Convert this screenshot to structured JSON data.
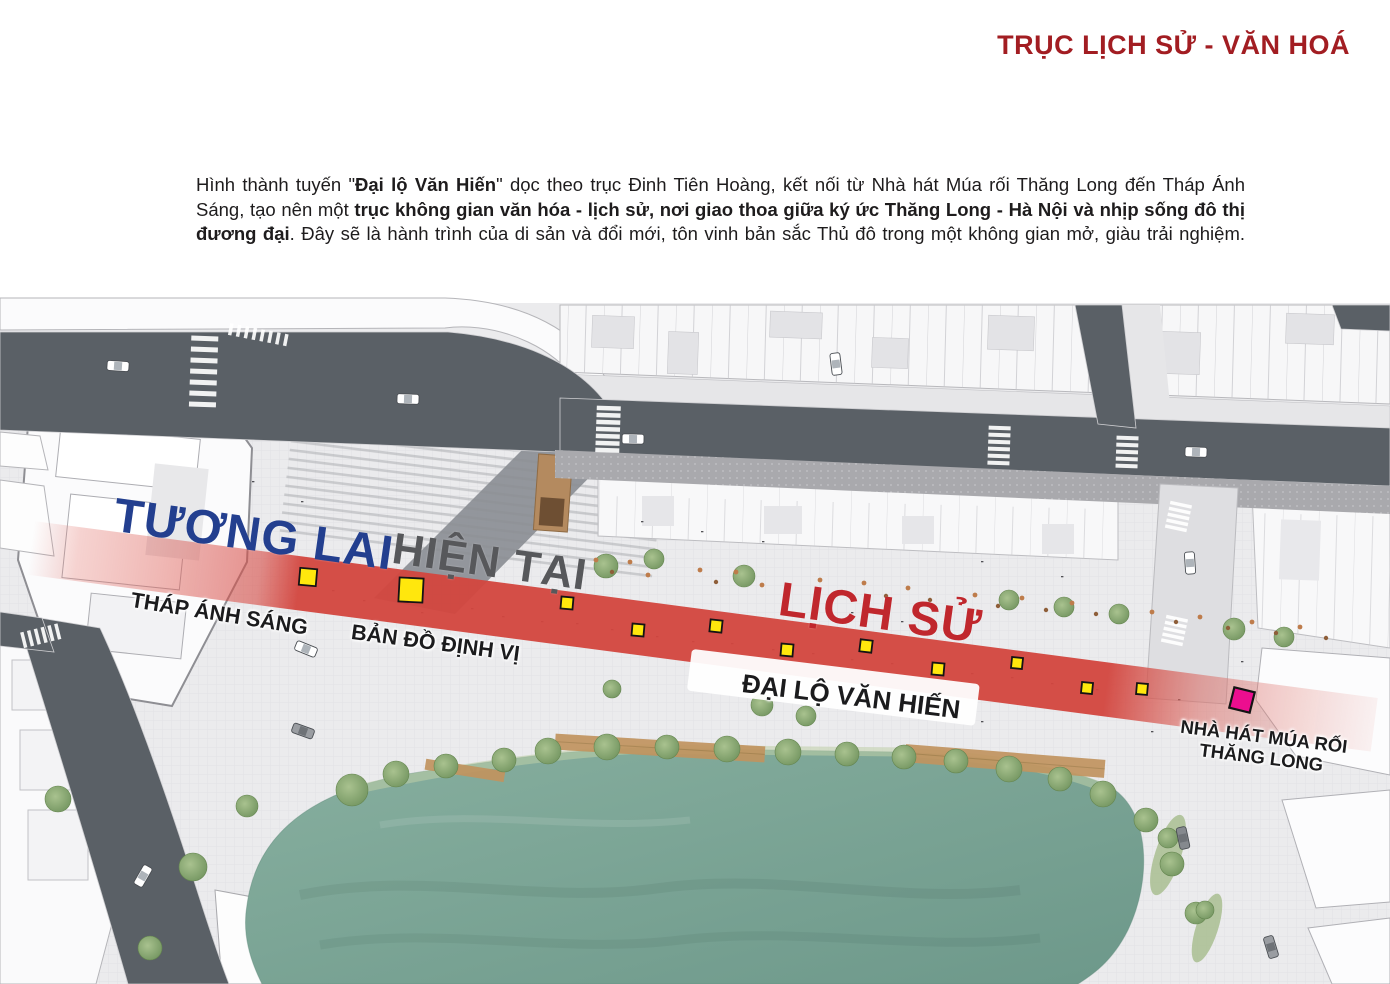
{
  "header": {
    "title": "TRỤC LỊCH SỬ - VĂN HOÁ",
    "title_color": "#A21D22"
  },
  "intro": {
    "lines": [
      {
        "segments": [
          {
            "t": "Hình thành tuyến \"",
            "b": false
          },
          {
            "t": "Đại lộ Văn Hiến",
            "b": true
          },
          {
            "t": "\" dọc theo trục Đinh Tiên Hoàng, kết nối từ Nhà hát Múa rối Thăng Long đến Tháp Ánh",
            "b": false
          }
        ]
      },
      {
        "segments": [
          {
            "t": "Sáng, tạo nên một ",
            "b": false
          },
          {
            "t": "trục không gian văn hóa - lịch sử, nơi giao thoa giữa ký ức Thăng Long - Hà Nội và nhịp sống đô thị",
            "b": true
          }
        ]
      },
      {
        "segments": [
          {
            "t": "đương đại",
            "b": true
          },
          {
            "t": ". Đây sẽ là hành trình của di sản và đổi mới, tôn vinh bản sắc Thủ đô trong một không gian mở, giàu trải nghiệm.",
            "b": false
          }
        ]
      }
    ]
  },
  "map": {
    "era_labels": [
      {
        "id": "tuong-lai",
        "text": "TƯƠNG LAI",
        "color": "#233F8F"
      },
      {
        "id": "hien-tai",
        "text": "HIỆN TẠI",
        "color": "#57585B"
      },
      {
        "id": "lich-su",
        "text": "LỊCH SỬ",
        "color": "#C0272D"
      }
    ],
    "place_labels": [
      {
        "id": "thap-anh-sang",
        "text": "THÁP ÁNH SÁNG"
      },
      {
        "id": "ban-do-dinh-vi",
        "text": "BẢN ĐỒ ĐỊNH VỊ"
      },
      {
        "id": "dai-lo-van-hien",
        "text": "ĐẠI LỘ VĂN HIẾN"
      },
      {
        "id": "nha-hat-mua-roi",
        "lines": [
          "NHÀ HÁT MÚA RỐI",
          "THĂNG LONG"
        ]
      }
    ],
    "colors": {
      "axis_red": "#D2453E",
      "lake_teal": "#7AA698",
      "road_gray": "#5A6066"
    },
    "marker_colors": {
      "node": "#FFE70D",
      "theater": "#EC0E8F",
      "border": "#141414"
    },
    "markers": [
      {
        "x": 308,
        "y": 577,
        "s": 17,
        "r": 5,
        "type": "node"
      },
      {
        "x": 411,
        "y": 590,
        "s": 24,
        "r": 3,
        "type": "node"
      },
      {
        "x": 567,
        "y": 603,
        "s": 12,
        "r": 5,
        "type": "node"
      },
      {
        "x": 638,
        "y": 630,
        "s": 12,
        "r": 5,
        "type": "node"
      },
      {
        "x": 716,
        "y": 626,
        "s": 12,
        "r": 6,
        "type": "node"
      },
      {
        "x": 787,
        "y": 650,
        "s": 12,
        "r": 5,
        "type": "node"
      },
      {
        "x": 866,
        "y": 646,
        "s": 12,
        "r": 7,
        "type": "node"
      },
      {
        "x": 938,
        "y": 669,
        "s": 12,
        "r": 5,
        "type": "node"
      },
      {
        "x": 1017,
        "y": 663,
        "s": 11,
        "r": 6,
        "type": "node"
      },
      {
        "x": 1087,
        "y": 688,
        "s": 11,
        "r": 6,
        "type": "node"
      },
      {
        "x": 1142,
        "y": 689,
        "s": 11,
        "r": 5,
        "type": "node"
      },
      {
        "x": 1242,
        "y": 700,
        "s": 21,
        "r": 14,
        "type": "theater"
      }
    ]
  }
}
